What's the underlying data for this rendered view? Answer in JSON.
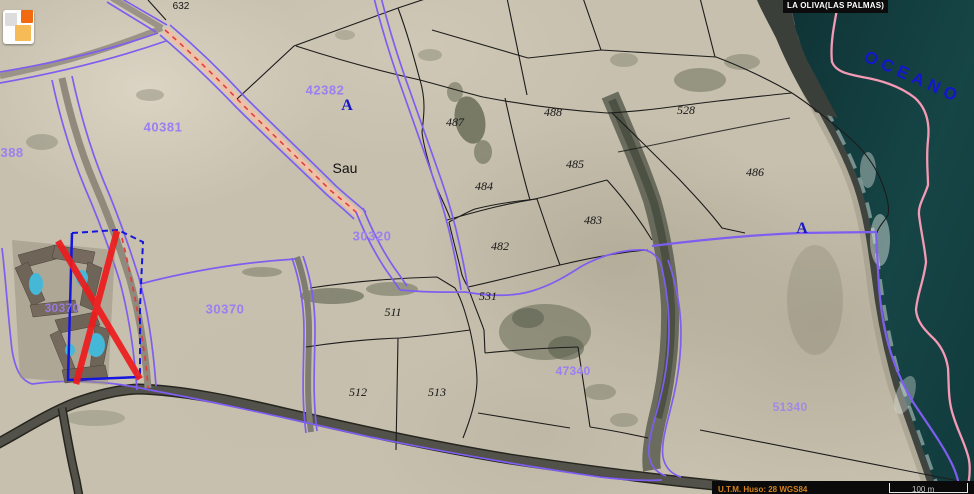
{
  "map": {
    "municipality_bar": "LA OLIVA(LAS PALMAS)",
    "ocean_label": "OCEANO",
    "place_label": "Sau",
    "road_label": "632",
    "zone_markers": {
      "a_west": "A",
      "a_east": "A"
    },
    "cadastral_codes": {
      "c40381": "40381",
      "c42382": "42382",
      "c30388": "30388",
      "c30320": "30320",
      "c30370_field": "30370",
      "c30370_hotel": "30370",
      "c47340": "47340",
      "c51340": "51340"
    },
    "parcel_numbers": {
      "p487": "487",
      "p488": "488",
      "p528": "528",
      "p484": "484",
      "p485": "485",
      "p486": "486",
      "p483": "483",
      "p482": "482",
      "p531": "531",
      "p511": "511",
      "p512": "512",
      "p513": "513"
    }
  },
  "statusbar": {
    "utm_label": "U.T.M. Huso: 28 WGS84",
    "scale_label": "100 m"
  },
  "colors": {
    "cadastral_line_purple": "#7e5ef0",
    "cadastral_text_purple": "#9d7ef2",
    "parcel_line_black": "#1c1c1c",
    "marker_blue": "#1717c8",
    "coastline_pink": "#f49ab4",
    "cross_red": "#ee1c1c",
    "ocean_teal": "#143e40",
    "road_fill_salmon": "#eec0a8"
  },
  "icons": {
    "logo": "map-app-logo"
  }
}
